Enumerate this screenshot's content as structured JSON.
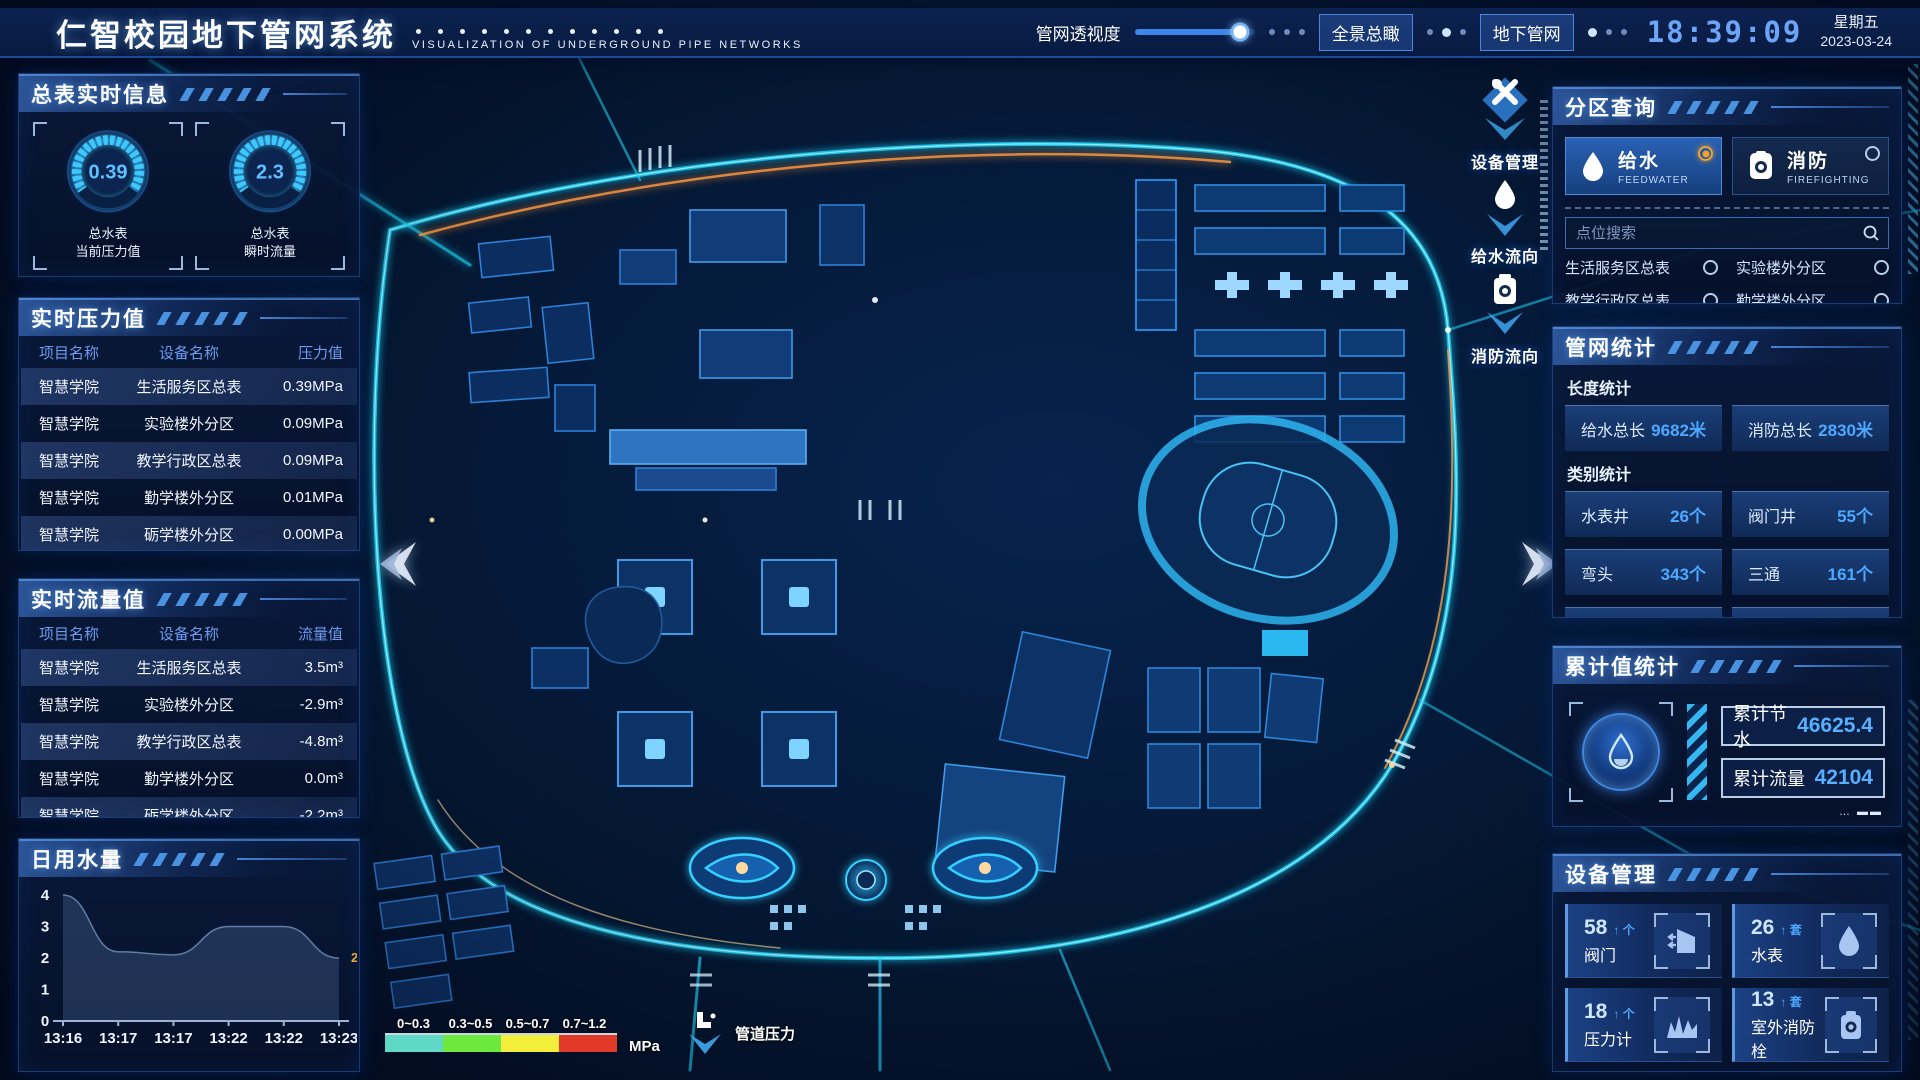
{
  "header": {
    "title": "仁智校园地下管网系统",
    "subtitle": "VISUALIZATION OF UNDERGROUND PIPE NETWORKS",
    "transparency_label": "管网透视度",
    "transparency_percent": 88,
    "buttons": {
      "overview": "全景总瞰",
      "underground": "地下管网"
    },
    "time": "18:39:09",
    "weekday": "星期五",
    "date": "2023-03-24"
  },
  "left": {
    "meter_panel": {
      "title": "总表实时信息",
      "gauges": [
        {
          "value": "0.39",
          "label_line1": "总水表",
          "label_line2": "当前压力值"
        },
        {
          "value": "2.3",
          "label_line1": "总水表",
          "label_line2": "瞬时流量"
        }
      ]
    },
    "pressure_panel": {
      "title": "实时压力值",
      "columns": [
        "项目名称",
        "设备名称",
        "压力值"
      ],
      "rows": [
        [
          "智慧学院",
          "生活服务区总表",
          "0.39MPa"
        ],
        [
          "智慧学院",
          "实验楼外分区",
          "0.09MPa"
        ],
        [
          "智慧学院",
          "教学行政区总表",
          "0.09MPa"
        ],
        [
          "智慧学院",
          "勤学楼外分区",
          "0.01MPa"
        ],
        [
          "智慧学院",
          "砺学楼外分区",
          "0.00MPa"
        ]
      ]
    },
    "flow_panel": {
      "title": "实时流量值",
      "columns": [
        "项目名称",
        "设备名称",
        "流量值"
      ],
      "rows": [
        [
          "智慧学院",
          "生活服务区总表",
          "3.5m³"
        ],
        [
          "智慧学院",
          "实验楼外分区",
          "-2.9m³"
        ],
        [
          "智慧学院",
          "教学行政区总表",
          "-4.8m³"
        ],
        [
          "智慧学院",
          "勤学楼外分区",
          "0.0m³"
        ],
        [
          "智慧学院",
          "砺学楼外分区",
          "-2.2m³"
        ]
      ]
    },
    "daily_panel": {
      "title": "日用水量"
    }
  },
  "chart_data": {
    "type": "area",
    "title": "日用水量",
    "x": [
      "13:16",
      "13:17",
      "13:17",
      "13:22",
      "13:22",
      "13:23"
    ],
    "values": [
      4,
      2.2,
      2.1,
      3,
      3,
      2
    ],
    "xlabel": "",
    "ylabel": "",
    "ylim": [
      0,
      4
    ],
    "yticks": [
      0,
      1,
      2,
      3,
      4
    ],
    "grid": false,
    "end_label": "2",
    "end_label_color": "#e8a93c",
    "area_color": "rgba(120,160,220,0.22)"
  },
  "right": {
    "zone_panel": {
      "title": "分区查询",
      "tabs": [
        {
          "label": "给水",
          "sub": "FEEDWATER",
          "selected": true
        },
        {
          "label": "消防",
          "sub": "FIREFIGHTING",
          "selected": false
        }
      ],
      "search_placeholder": "点位搜索",
      "items": [
        "生活服务区总表",
        "实验楼外分区",
        "教学行政区总表",
        "勤学楼外分区",
        "砺学楼外分区",
        "宿舍区泵房"
      ]
    },
    "stats_panel": {
      "title": "管网统计",
      "length_label": "长度统计",
      "length_stats": [
        {
          "label": "给水总长",
          "value": "9682米"
        },
        {
          "label": "消防总长",
          "value": "2830米"
        }
      ],
      "category_label": "类别统计",
      "category_stats": [
        {
          "label": "水表井",
          "value": "26个"
        },
        {
          "label": "阀门井",
          "value": "55个"
        },
        {
          "label": "弯头",
          "value": "343个"
        },
        {
          "label": "三通",
          "value": "161个"
        }
      ]
    },
    "cumulative_panel": {
      "title": "累计值统计",
      "rows": [
        {
          "label": "累计节水",
          "value": "46625.4"
        },
        {
          "label": "累计流量",
          "value": "42104"
        }
      ]
    },
    "device_panel": {
      "title": "设备管理",
      "cards": [
        {
          "count": "58",
          "unit": "个",
          "label": "阀门"
        },
        {
          "count": "26",
          "unit": "套",
          "label": "水表"
        },
        {
          "count": "18",
          "unit": "个",
          "label": "压力计"
        },
        {
          "count": "13",
          "unit": "套",
          "label": "室外消防栓"
        }
      ]
    }
  },
  "map": {
    "overlays": [
      {
        "label": "设备管理"
      },
      {
        "label": "给水流向"
      },
      {
        "label": "消防流向"
      }
    ],
    "legend": {
      "ranges": [
        {
          "label": "0~0.3",
          "color": "#5fd8c8"
        },
        {
          "label": "0.3~0.5",
          "color": "#6de83c"
        },
        {
          "label": "0.5~0.7",
          "color": "#f2ee3a"
        },
        {
          "label": "0.7~1.2",
          "color": "#e23a28"
        }
      ],
      "unit": "MPa",
      "pressure_label": "管道压力"
    }
  },
  "icons": {
    "up_arrow": "↑"
  },
  "colors": {
    "accent_blue": "#4fa8ff",
    "accent_orange": "#f0a32c",
    "road_cyan": "#1fd2f5",
    "road_orange": "#ff9b42"
  }
}
